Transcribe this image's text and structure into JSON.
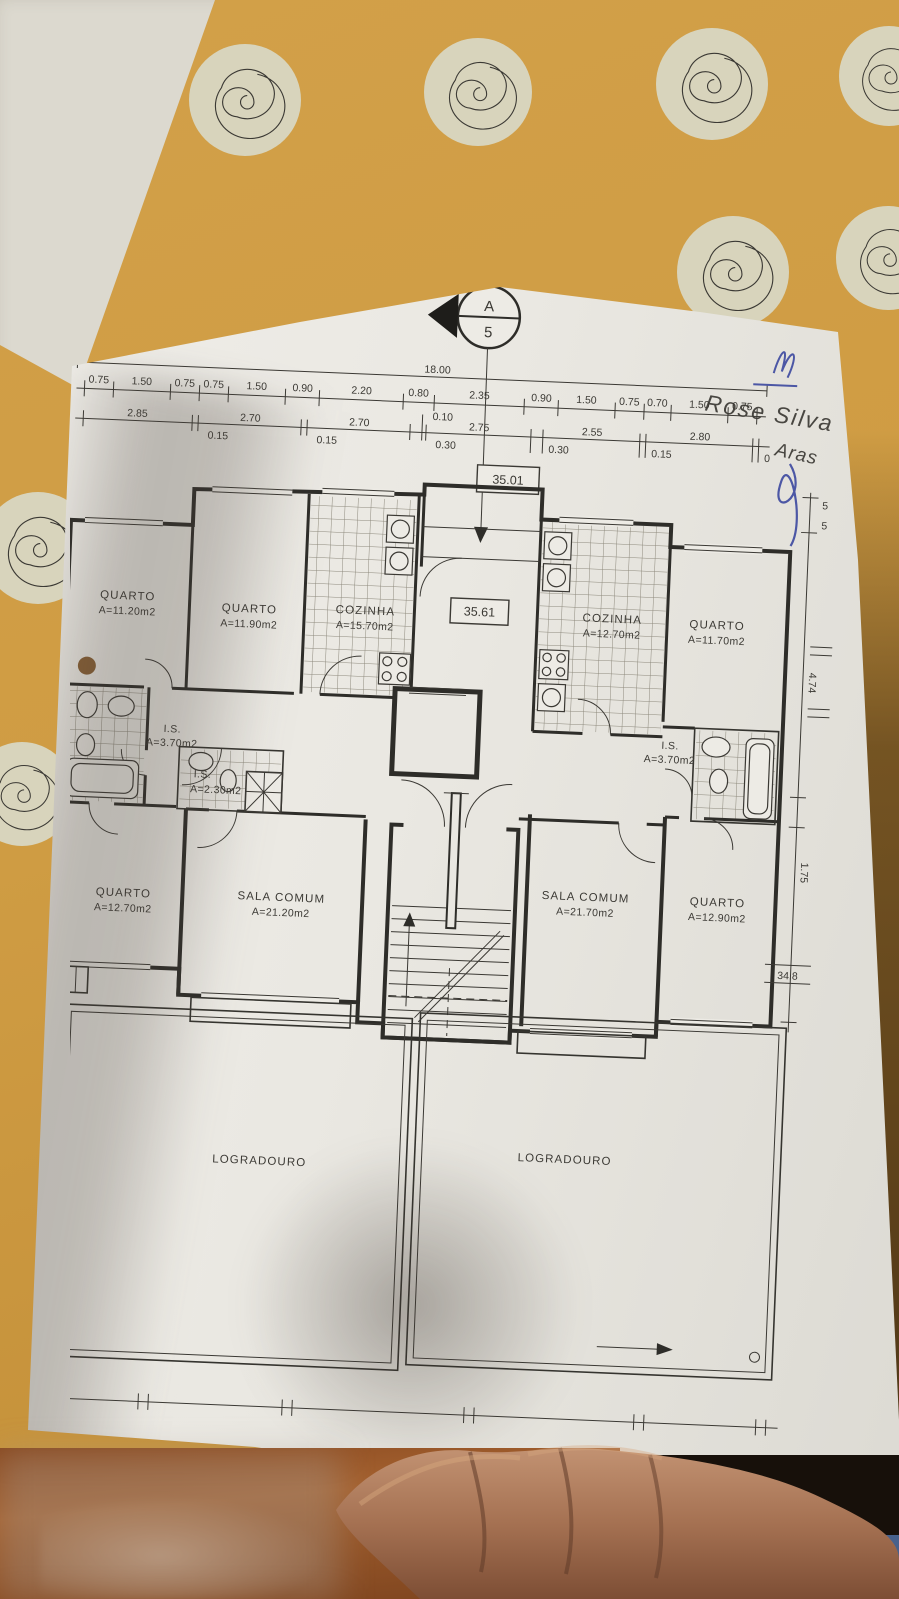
{
  "plan": {
    "overall_width_label": "18.00",
    "section": {
      "letter": "A",
      "number": "5"
    },
    "levels": [
      "35.01",
      "35.61"
    ],
    "elevation": "34.8",
    "dims_a": [
      "0.75",
      "1.50",
      "0.75",
      "0.75",
      "1.50",
      "0.90",
      "2.20",
      "0.80",
      "2.35",
      "0.90",
      "1.50",
      "0.75",
      "0.70",
      "1.50",
      "0.75"
    ],
    "dims_b": [
      "2.85",
      "0.15",
      "2.70",
      "0.15",
      "2.70",
      "0.30",
      "0.10",
      "2.75",
      "0.30",
      "2.55",
      "0.15",
      "2.80",
      "0"
    ],
    "dims_right": [
      "5",
      "5",
      "4.74",
      "1.75"
    ],
    "rooms": {
      "quarto1": {
        "name": "QUARTO",
        "area": "A=11.20m2"
      },
      "quarto2": {
        "name": "QUARTO",
        "area": "A=11.90m2"
      },
      "cozinha1": {
        "name": "COZINHA",
        "area": "A=15.70m2"
      },
      "cozinha2": {
        "name": "COZINHA",
        "area": "A=12.70m2"
      },
      "quarto3": {
        "name": "QUARTO",
        "area": "A=11.70m2"
      },
      "is1": {
        "name": "I.S.",
        "area": "A=3.70m2"
      },
      "is2": {
        "name": "I.S.",
        "area": "A=2.30m2"
      },
      "is3": {
        "name": "I.S.",
        "area": "A=3.70m2"
      },
      "quarto4": {
        "name": "QUARTO",
        "area": "A=12.70m2"
      },
      "sala1": {
        "name": "SALA COMUM",
        "area": "A=21.20m2"
      },
      "sala2": {
        "name": "SALA COMUM",
        "area": "A=21.70m2"
      },
      "quarto5": {
        "name": "QUARTO",
        "area": "A=12.90m2"
      }
    },
    "yards": [
      "LOGRADOURO",
      "LOGRADOURO"
    ]
  },
  "signature": {
    "line1": "Rose Silva",
    "line2": "Aras"
  }
}
